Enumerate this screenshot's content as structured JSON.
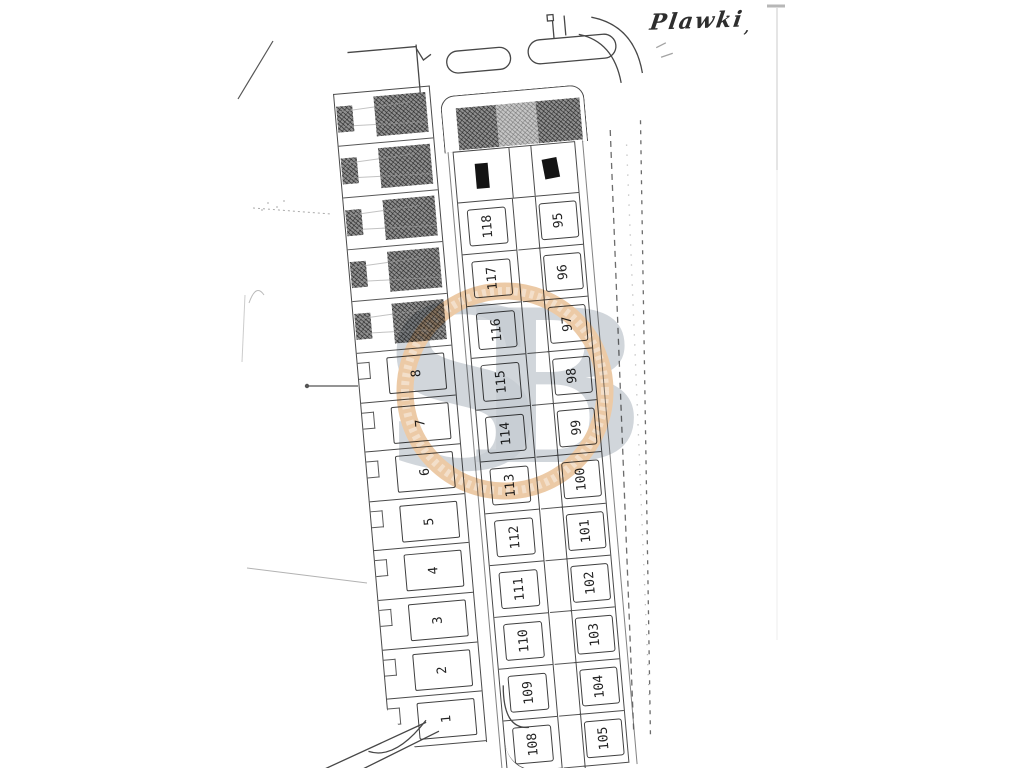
{
  "handwriting": {
    "label": "Plawki",
    "mark": ","
  },
  "watermark": {
    "letter_s": "S",
    "letter_b": "B",
    "ring_color": "#dd9f5e",
    "letters_color": "#98a2ad"
  },
  "left_strip": {
    "hatched_building_rows": 5,
    "plots": [
      "8",
      "7",
      "6",
      "5",
      "4",
      "3",
      "2",
      "1"
    ]
  },
  "block": {
    "left_column_plots": [
      "118",
      "117",
      "116",
      "115",
      "114",
      "113",
      "112",
      "111",
      "110",
      "109",
      "108"
    ],
    "right_column_plots": [
      "95",
      "96",
      "97",
      "98",
      "99",
      "100",
      "101",
      "102",
      "103",
      "104",
      "105"
    ]
  },
  "colors": {
    "line": "#4a4a4a",
    "hatch_dark": "#8f8f8f",
    "hatch_light": "#c6c6c6",
    "building_fill": "#141414"
  }
}
